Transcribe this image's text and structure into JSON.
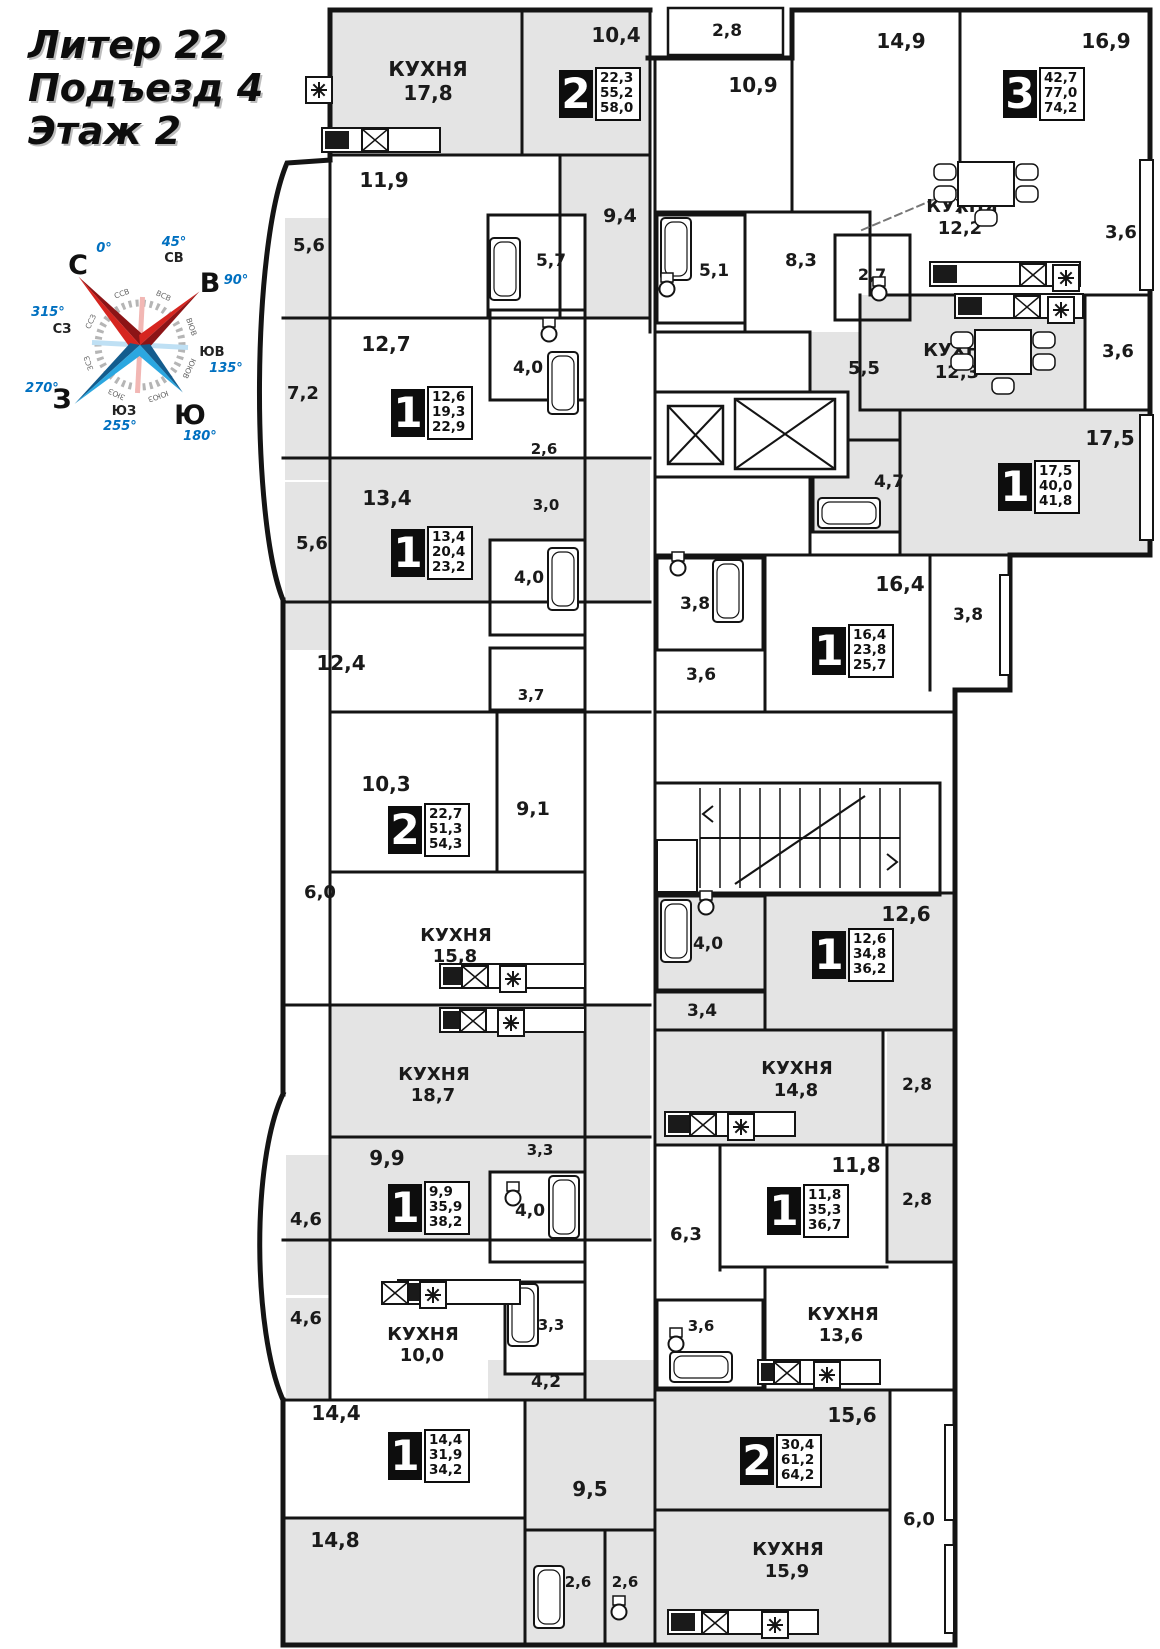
{
  "title": {
    "lines": [
      "Литер 22",
      "Подъезд 4",
      "Этаж 2"
    ]
  },
  "compass": {
    "cardinals": [
      {
        "label": "С",
        "x": 78,
        "y": 274
      },
      {
        "label": "В",
        "x": 210,
        "y": 292
      },
      {
        "label": "Ю",
        "x": 190,
        "y": 424
      },
      {
        "label": "З",
        "x": 62,
        "y": 408
      }
    ],
    "degrees": [
      {
        "label": "0°",
        "x": 104,
        "y": 252
      },
      {
        "label": "45°",
        "x": 174,
        "y": 246
      },
      {
        "label": "90°",
        "x": 236,
        "y": 284
      },
      {
        "label": "135°",
        "x": 226,
        "y": 372
      },
      {
        "label": "180°",
        "x": 200,
        "y": 440
      },
      {
        "label": "255°",
        "x": 120,
        "y": 430
      },
      {
        "label": "270°",
        "x": 42,
        "y": 392
      },
      {
        "label": "315°",
        "x": 48,
        "y": 316
      }
    ],
    "subdirs": [
      {
        "label": "СВ",
        "x": 174,
        "y": 262
      },
      {
        "label": "ЮВ",
        "x": 212,
        "y": 356
      },
      {
        "label": "ЮЗ",
        "x": 124,
        "y": 415
      },
      {
        "label": "СЗ",
        "x": 62,
        "y": 333
      }
    ],
    "ring": [
      "ССВ",
      "ВСВ",
      "ВЮВ",
      "ЮЮВ",
      "ЮЮЗ",
      "ЗЮЗ",
      "ЗСЗ",
      "ССЗ"
    ],
    "colors": {
      "red": "#d6251f",
      "red_dark": "#8c1416",
      "blue": "#2ba7e0",
      "blue_dark": "#135c8d",
      "degree_text": "#0070c0"
    }
  },
  "apartments": [
    {
      "rooms": "2",
      "areas": [
        "22,3",
        "55,2",
        "58,0"
      ],
      "x": 559,
      "y": 70
    },
    {
      "rooms": "3",
      "areas": [
        "42,7",
        "77,0",
        "74,2"
      ],
      "x": 1003,
      "y": 70
    },
    {
      "rooms": "1",
      "areas": [
        "12,6",
        "19,3",
        "22,9"
      ],
      "x": 391,
      "y": 389
    },
    {
      "rooms": "1",
      "areas": [
        "13,4",
        "20,4",
        "23,2"
      ],
      "x": 391,
      "y": 529
    },
    {
      "rooms": "1",
      "areas": [
        "17,5",
        "40,0",
        "41,8"
      ],
      "x": 998,
      "y": 463
    },
    {
      "rooms": "1",
      "areas": [
        "16,4",
        "23,8",
        "25,7"
      ],
      "x": 812,
      "y": 627
    },
    {
      "rooms": "2",
      "areas": [
        "22,7",
        "51,3",
        "54,3"
      ],
      "x": 388,
      "y": 806
    },
    {
      "rooms": "1",
      "areas": [
        "12,6",
        "34,8",
        "36,2"
      ],
      "x": 812,
      "y": 931
    },
    {
      "rooms": "1",
      "areas": [
        "9,9",
        "35,9",
        "38,2"
      ],
      "x": 388,
      "y": 1184
    },
    {
      "rooms": "1",
      "areas": [
        "11,8",
        "35,3",
        "36,7"
      ],
      "x": 767,
      "y": 1187
    },
    {
      "rooms": "1",
      "areas": [
        "14,4",
        "31,9",
        "34,2"
      ],
      "x": 388,
      "y": 1432
    },
    {
      "rooms": "2",
      "areas": [
        "30,4",
        "61,2",
        "64,2"
      ],
      "x": 740,
      "y": 1437
    }
  ],
  "room_labels": [
    {
      "t": "КУХНЯ",
      "x": 428,
      "y": 76,
      "s": 20
    },
    {
      "t": "17,8",
      "x": 428,
      "y": 100,
      "s": 20
    },
    {
      "t": "10,4",
      "x": 616,
      "y": 42,
      "s": 20
    },
    {
      "t": "2,8",
      "x": 727,
      "y": 36,
      "s": 17
    },
    {
      "t": "10,9",
      "x": 753,
      "y": 92,
      "s": 20
    },
    {
      "t": "14,9",
      "x": 901,
      "y": 48,
      "s": 20
    },
    {
      "t": "16,9",
      "x": 1106,
      "y": 48,
      "s": 20
    },
    {
      "t": "3,6",
      "x": 1121,
      "y": 238,
      "s": 18
    },
    {
      "t": "КУХНЯ",
      "x": 962,
      "y": 212,
      "s": 18
    },
    {
      "t": "12,2",
      "x": 960,
      "y": 234,
      "s": 18
    },
    {
      "t": "8,3",
      "x": 801,
      "y": 266,
      "s": 18
    },
    {
      "t": "2,7",
      "x": 872,
      "y": 280,
      "s": 16
    },
    {
      "t": "5,1",
      "x": 714,
      "y": 276,
      "s": 17
    },
    {
      "t": "9,4",
      "x": 620,
      "y": 222,
      "s": 19
    },
    {
      "t": "5,7",
      "x": 551,
      "y": 266,
      "s": 17
    },
    {
      "t": "5,6",
      "x": 309,
      "y": 251,
      "s": 18
    },
    {
      "t": "11,9",
      "x": 384,
      "y": 187,
      "s": 20
    },
    {
      "t": "12,7",
      "x": 386,
      "y": 351,
      "s": 20
    },
    {
      "t": "7,2",
      "x": 303,
      "y": 399,
      "s": 18
    },
    {
      "t": "4,0",
      "x": 528,
      "y": 373,
      "s": 17
    },
    {
      "t": "2,6",
      "x": 544,
      "y": 454,
      "s": 15
    },
    {
      "t": "5,5",
      "x": 864,
      "y": 374,
      "s": 18
    },
    {
      "t": "КУХНЯ",
      "x": 959,
      "y": 356,
      "s": 18
    },
    {
      "t": "12,3",
      "x": 957,
      "y": 378,
      "s": 18
    },
    {
      "t": "3,6",
      "x": 1118,
      "y": 357,
      "s": 18
    },
    {
      "t": "4,7",
      "x": 889,
      "y": 487,
      "s": 17
    },
    {
      "t": "17,5",
      "x": 1110,
      "y": 445,
      "s": 20
    },
    {
      "t": "13,4",
      "x": 387,
      "y": 505,
      "s": 20
    },
    {
      "t": "3,0",
      "x": 546,
      "y": 510,
      "s": 15
    },
    {
      "t": "5,6",
      "x": 312,
      "y": 549,
      "s": 18
    },
    {
      "t": "4,0",
      "x": 529,
      "y": 583,
      "s": 17
    },
    {
      "t": "3,8",
      "x": 695,
      "y": 609,
      "s": 17
    },
    {
      "t": "16,4",
      "x": 900,
      "y": 591,
      "s": 20
    },
    {
      "t": "3,6",
      "x": 701,
      "y": 680,
      "s": 17
    },
    {
      "t": "3,8",
      "x": 968,
      "y": 620,
      "s": 17
    },
    {
      "t": "12,4",
      "x": 341,
      "y": 670,
      "s": 20
    },
    {
      "t": "3,7",
      "x": 531,
      "y": 700,
      "s": 15
    },
    {
      "t": "10,3",
      "x": 386,
      "y": 791,
      "s": 20
    },
    {
      "t": "9,1",
      "x": 533,
      "y": 815,
      "s": 19
    },
    {
      "t": "6,0",
      "x": 320,
      "y": 898,
      "s": 18
    },
    {
      "t": "КУХНЯ",
      "x": 456,
      "y": 941,
      "s": 18
    },
    {
      "t": "15,8",
      "x": 455,
      "y": 962,
      "s": 18
    },
    {
      "t": "4,0",
      "x": 708,
      "y": 949,
      "s": 17
    },
    {
      "t": "12,6",
      "x": 906,
      "y": 921,
      "s": 20
    },
    {
      "t": "3,4",
      "x": 702,
      "y": 1016,
      "s": 17
    },
    {
      "t": "КУХНЯ",
      "x": 797,
      "y": 1074,
      "s": 18
    },
    {
      "t": "14,8",
      "x": 796,
      "y": 1096,
      "s": 18
    },
    {
      "t": "2,8",
      "x": 917,
      "y": 1090,
      "s": 17
    },
    {
      "t": "КУХНЯ",
      "x": 434,
      "y": 1080,
      "s": 18
    },
    {
      "t": "18,7",
      "x": 433,
      "y": 1101,
      "s": 18
    },
    {
      "t": "3,3",
      "x": 540,
      "y": 1155,
      "s": 15
    },
    {
      "t": "9,9",
      "x": 387,
      "y": 1165,
      "s": 20
    },
    {
      "t": "4,0",
      "x": 530,
      "y": 1216,
      "s": 17
    },
    {
      "t": "4,6",
      "x": 306,
      "y": 1225,
      "s": 18
    },
    {
      "t": "11,8",
      "x": 856,
      "y": 1172,
      "s": 20
    },
    {
      "t": "2,8",
      "x": 917,
      "y": 1205,
      "s": 17
    },
    {
      "t": "6,3",
      "x": 686,
      "y": 1240,
      "s": 18
    },
    {
      "t": "4,6",
      "x": 306,
      "y": 1324,
      "s": 18
    },
    {
      "t": "3,6",
      "x": 701,
      "y": 1331,
      "s": 15
    },
    {
      "t": "КУХНЯ",
      "x": 843,
      "y": 1320,
      "s": 18
    },
    {
      "t": "13,6",
      "x": 841,
      "y": 1341,
      "s": 18
    },
    {
      "t": "КУХНЯ",
      "x": 423,
      "y": 1340,
      "s": 18
    },
    {
      "t": "10,0",
      "x": 422,
      "y": 1361,
      "s": 18
    },
    {
      "t": "3,3",
      "x": 551,
      "y": 1330,
      "s": 15
    },
    {
      "t": "4,2",
      "x": 546,
      "y": 1387,
      "s": 17
    },
    {
      "t": "14,4",
      "x": 336,
      "y": 1420,
      "s": 20
    },
    {
      "t": "15,6",
      "x": 852,
      "y": 1422,
      "s": 20
    },
    {
      "t": "9,5",
      "x": 590,
      "y": 1496,
      "s": 20
    },
    {
      "t": "6,0",
      "x": 919,
      "y": 1525,
      "s": 18
    },
    {
      "t": "14,8",
      "x": 335,
      "y": 1547,
      "s": 20
    },
    {
      "t": "КУХНЯ",
      "x": 788,
      "y": 1555,
      "s": 18
    },
    {
      "t": "15,9",
      "x": 787,
      "y": 1577,
      "s": 18
    },
    {
      "t": "2,6",
      "x": 578,
      "y": 1587,
      "s": 15
    },
    {
      "t": "2,6",
      "x": 625,
      "y": 1587,
      "s": 15
    }
  ],
  "fixtures": {
    "tubs": [
      {
        "x": 490,
        "y": 238,
        "o": "v"
      },
      {
        "x": 548,
        "y": 352,
        "o": "v"
      },
      {
        "x": 548,
        "y": 548,
        "o": "v"
      },
      {
        "x": 661,
        "y": 218,
        "o": "v"
      },
      {
        "x": 818,
        "y": 498,
        "o": "h"
      },
      {
        "x": 713,
        "y": 560,
        "o": "v"
      },
      {
        "x": 661,
        "y": 900,
        "o": "v"
      },
      {
        "x": 549,
        "y": 1176,
        "o": "v"
      },
      {
        "x": 508,
        "y": 1284,
        "o": "v"
      },
      {
        "x": 670,
        "y": 1352,
        "o": "h"
      },
      {
        "x": 534,
        "y": 1566,
        "o": "v"
      }
    ],
    "toilets": [
      {
        "x": 667,
        "y": 289
      },
      {
        "x": 879,
        "y": 293
      },
      {
        "x": 549,
        "y": 334
      },
      {
        "x": 678,
        "y": 568
      },
      {
        "x": 706,
        "y": 907
      },
      {
        "x": 513,
        "y": 1198
      },
      {
        "x": 676,
        "y": 1344
      },
      {
        "x": 619,
        "y": 1612
      }
    ],
    "counters": [
      {
        "x": 322,
        "y": 128,
        "w": 118
      },
      {
        "x": 930,
        "y": 262,
        "w": 150
      },
      {
        "x": 955,
        "y": 294,
        "w": 128
      },
      {
        "x": 440,
        "y": 964,
        "w": 145
      },
      {
        "x": 440,
        "y": 1008,
        "w": 145
      },
      {
        "x": 665,
        "y": 1112,
        "w": 130
      },
      {
        "x": 758,
        "y": 1360,
        "w": 122
      },
      {
        "x": 398,
        "y": 1280,
        "w": 122
      },
      {
        "x": 668,
        "y": 1610,
        "w": 150
      }
    ],
    "sinks": [
      {
        "x": 362,
        "y": 129
      },
      {
        "x": 1020,
        "y": 264
      },
      {
        "x": 1014,
        "y": 296
      },
      {
        "x": 462,
        "y": 966
      },
      {
        "x": 460,
        "y": 1010
      },
      {
        "x": 690,
        "y": 1114
      },
      {
        "x": 774,
        "y": 1362
      },
      {
        "x": 382,
        "y": 1282
      },
      {
        "x": 702,
        "y": 1612
      }
    ],
    "asterisks": [
      {
        "x": 306,
        "y": 77
      },
      {
        "x": 1053,
        "y": 265
      },
      {
        "x": 1048,
        "y": 297
      },
      {
        "x": 500,
        "y": 966
      },
      {
        "x": 498,
        "y": 1010
      },
      {
        "x": 728,
        "y": 1114
      },
      {
        "x": 814,
        "y": 1362
      },
      {
        "x": 420,
        "y": 1282
      },
      {
        "x": 762,
        "y": 1612
      }
    ],
    "tables": [
      {
        "x": 958,
        "y": 162
      },
      {
        "x": 975,
        "y": 330
      }
    ]
  },
  "colors": {
    "wall": "#141414",
    "room_fill": "#e4e4e4",
    "bg": "#ffffff"
  }
}
